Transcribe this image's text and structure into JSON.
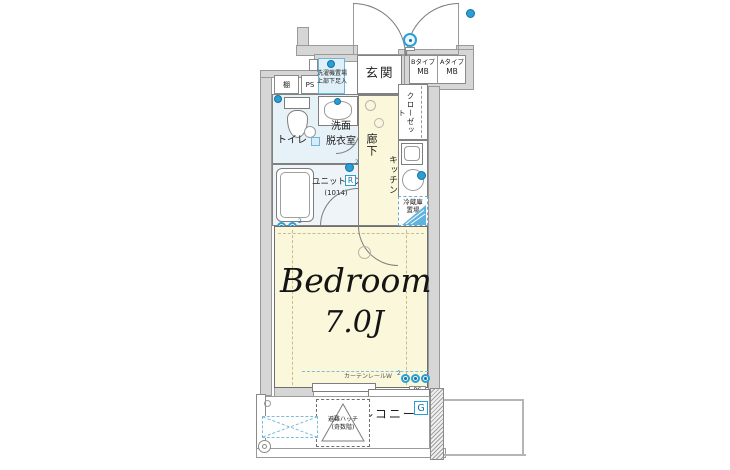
{
  "colors": {
    "wall": "#d6d6d6",
    "outline": "#8a8a8a",
    "room_yellow": "#faf7da",
    "wet_blue": "#e6f1f8",
    "fixture_blue": "#2b9fd4",
    "label_blue": "#16719f"
  },
  "plan": {
    "entrance": {
      "label": "玄関"
    },
    "meter_box": {
      "b_type": "Bタイプ",
      "b_mb": "MB",
      "a_type": "Aタイプ",
      "a_mb": "MB"
    },
    "utility": {
      "shelf": "棚",
      "pipe_space": "PS",
      "washing_line1": "洗濯機置場",
      "washing_line2": "上部下足入"
    },
    "sanitary": {
      "toilet": "トイレ",
      "wash_line1": "洗面",
      "wash_line2": "脱衣室",
      "unit_bath": "ユニットバス",
      "unit_bath_size": "(1014)",
      "r_label": "R",
      "sup2": "2"
    },
    "hall": {
      "label": "廊下"
    },
    "closet": {
      "label": "クローゼット"
    },
    "kitchen": {
      "label": "キッチン",
      "fridge_line1": "冷蔵庫",
      "fridge_line2": "置場",
      "ip_label": "IP"
    },
    "bedroom": {
      "name": "Bedroom",
      "size": "7.0J",
      "curtain_rail": "カーテンレールW",
      "sup2": "2"
    },
    "balcony": {
      "label": "バルコニー",
      "hatch_line1": "避難ハッチ",
      "hatch_line2": "(奇数階)",
      "g_label": "G",
      "ps_label": "PS"
    }
  }
}
